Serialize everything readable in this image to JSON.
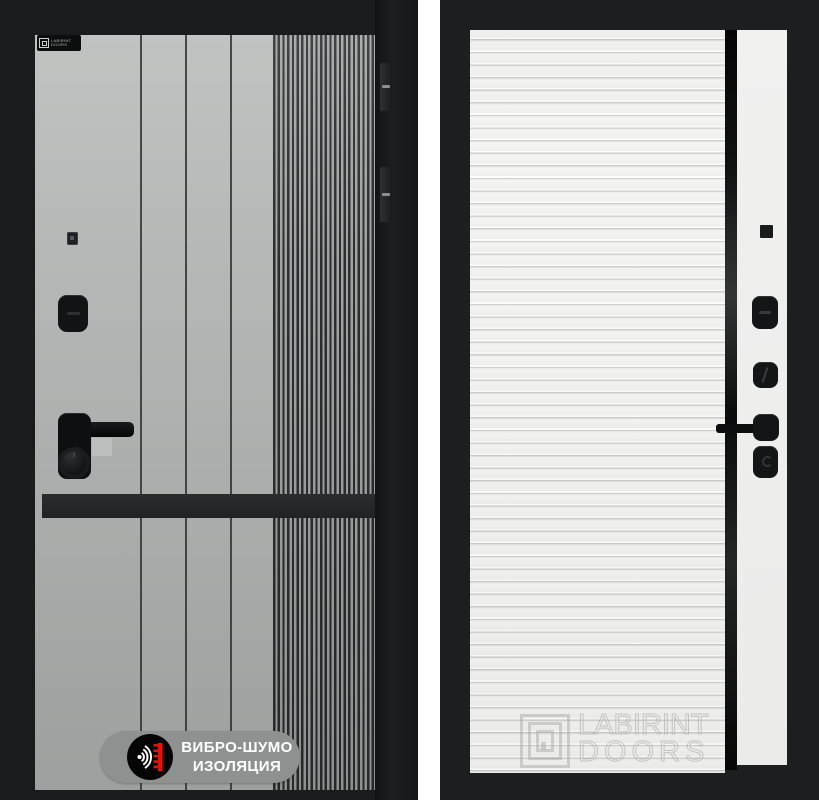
{
  "left_door": {
    "brand_badge": {
      "line1": "LABIRINT",
      "line2": "DOORS"
    },
    "feature_badge": {
      "line1": "ВИБРО-ШУМО",
      "line2": "ИЗОЛЯЦИЯ"
    },
    "colors": {
      "frame": "#1a1b1c",
      "panel_gray": "#b0b2b1",
      "decor_band": "#242627",
      "badge_pill": "#8f9190",
      "icon_accent_red": "#e3120b",
      "icon_wave_white": "#ffffff"
    }
  },
  "right_door": {
    "watermark": {
      "line1": "LABIRINT",
      "line2": "DOORS"
    },
    "colors": {
      "frame": "#1d1e1f",
      "panel_white": "#f3f3f2",
      "handle_strip_black": "#0c0d0e"
    }
  }
}
